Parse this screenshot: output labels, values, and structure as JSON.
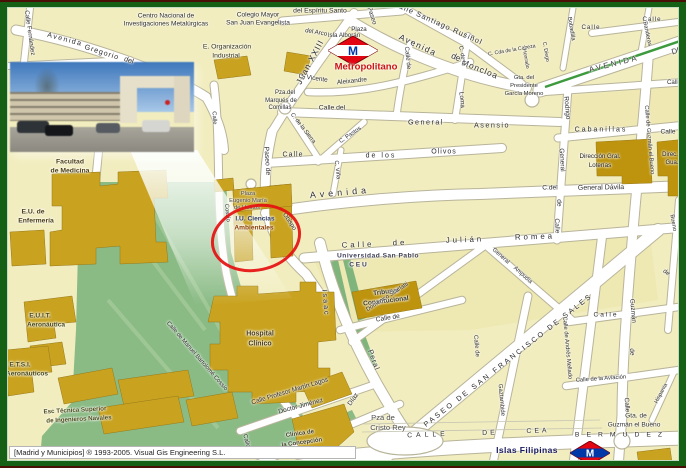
{
  "frame": {
    "copyright": "[Madrid y Municipios] ® 1993-2005. Visual Gis Engineering S.L.",
    "border_color": "#156015",
    "edge_line_color": "#4a1006"
  },
  "metro": {
    "m": "M",
    "top_label": "Metropolitano",
    "bottom_label": "Islas Filipinas",
    "diamond_color": "#e30613",
    "band_top_color": "#ffffff",
    "m_top_color": "#0038a8",
    "band_bottom_color": "#0038a8",
    "m_bottom_color": "#ffffff"
  },
  "colors": {
    "map_bg": "#f2edbe",
    "road": "#ffffff",
    "road_casing": "#b8b49a",
    "park": "#8abb85",
    "building": "#c9a320",
    "building_dark": "#be940e",
    "highlight_circle": "#e51010",
    "avenue_median_green": "#3d9a3d"
  },
  "map": {
    "labels": [
      {
        "t": "Centro Nacional de",
        "x": 166,
        "y": 17,
        "s": 6.6
      },
      {
        "t": "Investigaciones Metalúrgicas",
        "x": 166,
        "y": 25,
        "s": 6.6
      },
      {
        "t": "Colegio Mayor",
        "x": 258,
        "y": 16,
        "s": 6.6
      },
      {
        "t": "San Juan Evangelista",
        "x": 258,
        "y": 24,
        "s": 6.6
      },
      {
        "t": "del Espíritu Santo",
        "x": 320,
        "y": 12,
        "s": 6.8
      },
      {
        "t": "Avenida",
        "x": 65,
        "y": 39,
        "r": 15,
        "s": 7.2,
        "ls": 1.5
      },
      {
        "t": "Gregorio",
        "x": 102,
        "y": 52,
        "r": 18,
        "s": 7.2,
        "ls": 1
      },
      {
        "t": "del",
        "x": 129,
        "y": 60,
        "r": 20,
        "s": 7.2
      },
      {
        "t": "Calle Fernández",
        "x": 29,
        "y": 33,
        "r": 82,
        "s": 6.2
      },
      {
        "t": "E. Organización",
        "x": 227,
        "y": 48,
        "s": 6.8,
        "c": "#33331c"
      },
      {
        "t": "Industrial",
        "x": 226,
        "y": 57,
        "s": 6.8,
        "c": "#33331c"
      },
      {
        "t": "Paseo",
        "x": 371,
        "y": 16,
        "r": 72,
        "s": 6.4
      },
      {
        "t": "Plaza",
        "x": 359,
        "y": 30,
        "s": 6.2
      },
      {
        "t": "Isla Alborán",
        "x": 344,
        "y": 36,
        "s": 6.2
      },
      {
        "t": "del Arco",
        "x": 316,
        "y": 33,
        "r": 10,
        "s": 6.2
      },
      {
        "t": "Juan XXIII",
        "x": 310,
        "y": 62,
        "r": -62,
        "s": 8.5,
        "ls": 1
      },
      {
        "t": "C. Vicente",
        "x": 313,
        "y": 79,
        "r": 8,
        "s": 6.4
      },
      {
        "t": "Aleixandre",
        "x": 352,
        "y": 82,
        "r": -6,
        "s": 6.4
      },
      {
        "t": "Calle Santiago Rusiñol",
        "x": 438,
        "y": 23,
        "r": 24,
        "s": 7.4,
        "ls": 1
      },
      {
        "t": "Avenida",
        "x": 418,
        "y": 45,
        "r": 25,
        "s": 8.4,
        "ls": 1.5
      },
      {
        "t": "de",
        "x": 456,
        "y": 57,
        "r": 25,
        "s": 8.4
      },
      {
        "t": "Moncloa",
        "x": 480,
        "y": 69,
        "r": 22,
        "s": 8.4,
        "ls": 1
      },
      {
        "t": "C. Cda de la Cabeza",
        "x": 512,
        "y": 51,
        "r": -10,
        "s": 5.2
      },
      {
        "t": "Honrado",
        "x": 525,
        "y": 59,
        "r": 80,
        "s": 5.2
      },
      {
        "t": "C. Diego",
        "x": 545,
        "y": 52,
        "r": 80,
        "s": 5.2
      },
      {
        "t": "Gta. del",
        "x": 524,
        "y": 79,
        "s": 5.8
      },
      {
        "t": "Presidente",
        "x": 524,
        "y": 87,
        "s": 5.8
      },
      {
        "t": "García Moreno",
        "x": 524,
        "y": 95,
        "s": 5.8
      },
      {
        "t": "AVENIDA",
        "x": 614,
        "y": 64,
        "r": -14,
        "s": 7.8,
        "ls": 2.5,
        "c": "#3a3a3a"
      },
      {
        "t": "DE",
        "x": 677,
        "y": 51,
        "r": -16,
        "s": 7.8,
        "c": "#3a3a3a"
      },
      {
        "t": "Calle",
        "x": 591,
        "y": 28,
        "s": 6.2,
        "ls": 1
      },
      {
        "t": "Calle",
        "x": 652,
        "y": 20,
        "s": 6.2,
        "ls": 1
      },
      {
        "t": "Bobadilla",
        "x": 570,
        "y": 29,
        "r": 80,
        "s": 5.8
      },
      {
        "t": "Banderas",
        "x": 646,
        "y": 34,
        "r": 78,
        "s": 5.8
      },
      {
        "t": "Calle de",
        "x": 407,
        "y": 58,
        "r": 84,
        "s": 6.2
      },
      {
        "t": "C. de la",
        "x": 461,
        "y": 56,
        "r": 80,
        "s": 5.8
      },
      {
        "t": "Loma",
        "x": 461,
        "y": 100,
        "r": 84,
        "s": 6.4
      },
      {
        "t": "Pza.del",
        "x": 285,
        "y": 93,
        "s": 6
      },
      {
        "t": "Marqués de",
        "x": 281,
        "y": 101,
        "s": 6
      },
      {
        "t": "Comillas",
        "x": 280,
        "y": 108,
        "s": 6
      },
      {
        "t": "Calle del",
        "x": 332,
        "y": 109,
        "s": 6.8
      },
      {
        "t": "General",
        "x": 426,
        "y": 122,
        "s": 7.2,
        "ls": 1.5
      },
      {
        "t": "Asensio",
        "x": 492,
        "y": 125,
        "s": 7.2,
        "ls": 1.5
      },
      {
        "t": "Rodrigo",
        "x": 566,
        "y": 108,
        "r": 85,
        "s": 6.6
      },
      {
        "t": "General",
        "x": 561,
        "y": 160,
        "r": 87,
        "s": 6.6
      },
      {
        "t": "de",
        "x": 558,
        "y": 203,
        "r": 87,
        "s": 6.6
      },
      {
        "t": "Calle",
        "x": 556,
        "y": 226,
        "r": 87,
        "s": 6.6
      },
      {
        "t": "Cabanillas",
        "x": 601,
        "y": 130,
        "s": 7,
        "ls": 2
      },
      {
        "t": "Calle",
        "x": 668,
        "y": 133,
        "s": 6.6
      },
      {
        "t": "Calle",
        "x": 674,
        "y": 83,
        "s": 6.2
      },
      {
        "t": "Dirección Gral.",
        "x": 600,
        "y": 157,
        "s": 6.2,
        "c": "#1f1f1f"
      },
      {
        "t": "Loterías",
        "x": 600,
        "y": 166,
        "s": 6.2,
        "c": "#1f1f1f"
      },
      {
        "t": "Direc.",
        "x": 670,
        "y": 155,
        "s": 6,
        "c": "#1f1f1f"
      },
      {
        "t": "Gua.",
        "x": 672,
        "y": 163,
        "s": 6,
        "c": "#1f1f1f"
      },
      {
        "t": "Calle",
        "x": 293,
        "y": 155,
        "s": 7,
        "ls": 1
      },
      {
        "t": "de los",
        "x": 381,
        "y": 156,
        "s": 7,
        "ls": 2
      },
      {
        "t": "Olivos",
        "x": 444,
        "y": 152,
        "s": 7,
        "ls": 1
      },
      {
        "t": "C. de la Sierra",
        "x": 302,
        "y": 129,
        "r": 52,
        "s": 5.8
      },
      {
        "t": "C. Pastos",
        "x": 351,
        "y": 136,
        "r": -35,
        "s": 5.8
      },
      {
        "t": "C. Viña",
        "x": 336,
        "y": 170,
        "r": 84,
        "s": 5.8
      },
      {
        "t": "Paseo de",
        "x": 266,
        "y": 161,
        "r": 86,
        "s": 6.8
      },
      {
        "t": "Avenida",
        "x": 340,
        "y": 193,
        "r": -5,
        "s": 9,
        "ls": 4
      },
      {
        "t": "C.del",
        "x": 550,
        "y": 189,
        "s": 6.6
      },
      {
        "t": "General Dávila",
        "x": 601,
        "y": 188,
        "r": -1,
        "s": 7
      },
      {
        "t": "Obispo",
        "x": 289,
        "y": 222,
        "r": 56,
        "s": 6.2
      },
      {
        "t": "Plaza",
        "x": 248,
        "y": 195,
        "s": 5.8,
        "c": "#4a4a4a"
      },
      {
        "t": "Eugenio María",
        "x": 248,
        "y": 202,
        "s": 5.8,
        "c": "#4a4a4a"
      },
      {
        "t": "de Hostos",
        "x": 247,
        "y": 209,
        "s": 5.8,
        "c": "#4a4a4a"
      },
      {
        "t": "I.U. Ciencias",
        "x": 255,
        "y": 220,
        "s": 6.6,
        "w": 700,
        "c": "#2a3a62"
      },
      {
        "t": "Ambientales",
        "x": 254,
        "y": 229,
        "s": 6.6,
        "w": 700,
        "c": "#8a3d00"
      },
      {
        "t": "Universidad San Pablo",
        "x": 378,
        "y": 257,
        "s": 6.6,
        "w": 700,
        "c": "#3e3e58",
        "ls": 0.5
      },
      {
        "t": "C E U",
        "x": 358,
        "y": 266,
        "s": 6.6,
        "w": 700,
        "c": "#3e3e58"
      },
      {
        "t": "Calle",
        "x": 358,
        "y": 245,
        "r": -2,
        "s": 7.8,
        "ls": 3
      },
      {
        "t": "de",
        "x": 400,
        "y": 243,
        "r": -2,
        "s": 7.8,
        "ls": 3
      },
      {
        "t": "Julián",
        "x": 465,
        "y": 240,
        "r": -2,
        "s": 7.8,
        "ls": 3
      },
      {
        "t": "Romea",
        "x": 535,
        "y": 237,
        "r": -2,
        "s": 7.8,
        "ls": 3
      },
      {
        "t": "Tribunal",
        "x": 386,
        "y": 293,
        "r": -7,
        "s": 6.6,
        "w": 700,
        "c": "#3a3a26"
      },
      {
        "t": "Constitucional",
        "x": 386,
        "y": 302,
        "r": -7,
        "s": 6.6,
        "w": 700,
        "c": "#3a3a26"
      },
      {
        "t": "Calle de",
        "x": 388,
        "y": 319,
        "r": -9,
        "s": 6.6
      },
      {
        "t": "Domenico Scarlatti",
        "x": 388,
        "y": 298,
        "r": -33,
        "s": 5.8
      },
      {
        "t": "General",
        "x": 500,
        "y": 257,
        "r": 42,
        "s": 5.8
      },
      {
        "t": "Ampudia",
        "x": 522,
        "y": 276,
        "r": 42,
        "s": 5.8
      },
      {
        "t": "PASEO DE SAN FRANCISCO DE SALES",
        "x": 508,
        "y": 360,
        "r": -38,
        "s": 7.2,
        "ls": 2.5
      },
      {
        "t": "Isaac",
        "x": 326,
        "y": 303,
        "r": 85,
        "s": 7.2,
        "ls": 2
      },
      {
        "t": "Peral",
        "x": 374,
        "y": 360,
        "r": 70,
        "s": 7.2,
        "ls": 1
      },
      {
        "t": "Calle",
        "x": 213,
        "y": 118,
        "r": 86,
        "s": 5.8
      },
      {
        "t": "Cossío",
        "x": 226,
        "y": 213,
        "r": 84,
        "s": 5.8
      },
      {
        "t": "Calle de Manuel Bartolomé Cossío",
        "x": 196,
        "y": 357,
        "r": 49,
        "s": 5.8
      },
      {
        "t": "Hospital",
        "x": 260,
        "y": 334,
        "s": 7,
        "w": 700,
        "c": "#4a3c14"
      },
      {
        "t": "Clínico",
        "x": 260,
        "y": 344,
        "s": 7,
        "w": 700,
        "c": "#4a3c14"
      },
      {
        "t": "Calle Profesor Martín Lagos",
        "x": 290,
        "y": 392,
        "r": -17,
        "s": 6.4
      },
      {
        "t": "Doctor Jiménez",
        "x": 301,
        "y": 407,
        "r": -15,
        "s": 6.6
      },
      {
        "t": "Díaz",
        "x": 354,
        "y": 400,
        "r": -55,
        "s": 6.6
      },
      {
        "t": "Calle",
        "x": 246,
        "y": 441,
        "r": 75,
        "s": 6
      },
      {
        "t": "Clínica de",
        "x": 300,
        "y": 434,
        "r": -8,
        "s": 6,
        "w": 700,
        "c": "#3f3f23"
      },
      {
        "t": "la Concepción",
        "x": 302,
        "y": 443,
        "r": -8,
        "s": 6,
        "w": 700,
        "c": "#3f3f23"
      },
      {
        "t": "Pza de",
        "x": 383,
        "y": 418,
        "s": 7.6,
        "c": "#4f4f4f"
      },
      {
        "t": "Cristo Rey",
        "x": 388,
        "y": 428,
        "s": 7.6,
        "c": "#4f4f4f"
      },
      {
        "t": "CALLE",
        "x": 428,
        "y": 436,
        "r": -2,
        "s": 6.8,
        "ls": 4
      },
      {
        "t": "DE",
        "x": 490,
        "y": 434,
        "r": -2,
        "s": 6.8,
        "ls": 3
      },
      {
        "t": "CEA",
        "x": 538,
        "y": 432,
        "r": -2,
        "s": 6.8,
        "ls": 3
      },
      {
        "t": "BERMUDEZ",
        "x": 622,
        "y": 436,
        "s": 6.8,
        "ls": 7
      },
      {
        "t": "Gta. de",
        "x": 636,
        "y": 417,
        "s": 6.6,
        "c": "#333333"
      },
      {
        "t": "Guzmán el Bueno",
        "x": 634,
        "y": 426,
        "s": 6.6,
        "c": "#333333"
      },
      {
        "t": "Calle de Andrés Mellado",
        "x": 566,
        "y": 348,
        "r": 85,
        "s": 5.8
      },
      {
        "t": "Guzmán",
        "x": 632,
        "y": 311,
        "r": 85,
        "s": 6.4
      },
      {
        "t": "de",
        "x": 631,
        "y": 352,
        "r": 85,
        "s": 6.4
      },
      {
        "t": "Calle",
        "x": 626,
        "y": 405,
        "r": 85,
        "s": 6.4
      },
      {
        "t": "Calle de Guzmán el Bueno",
        "x": 648,
        "y": 140,
        "r": 85,
        "s": 5.8
      },
      {
        "t": "Bueno",
        "x": 672,
        "y": 223,
        "r": 80,
        "s": 5.8
      },
      {
        "t": "Calle de la Aviación",
        "x": 601,
        "y": 380,
        "r": -4,
        "s": 5.8
      },
      {
        "t": "Hispania",
        "x": 662,
        "y": 394,
        "r": -62,
        "s": 5.6
      },
      {
        "t": "Gaztambide",
        "x": 501,
        "y": 400,
        "r": 85,
        "s": 6
      },
      {
        "t": "Calle de",
        "x": 476,
        "y": 346,
        "r": 85,
        "s": 6
      },
      {
        "t": "Calle",
        "x": 606,
        "y": 316,
        "s": 6.6,
        "ls": 2
      },
      {
        "t": "de",
        "x": 666,
        "y": 273,
        "r": 35,
        "s": 6.2
      },
      {
        "t": "Facultad",
        "x": 70,
        "y": 163,
        "s": 6.8,
        "w": 700,
        "c": "#4a3c14"
      },
      {
        "t": "de Medicina",
        "x": 70,
        "y": 172,
        "s": 6.8,
        "w": 700,
        "c": "#4a3c14"
      },
      {
        "t": "E.U. de",
        "x": 33,
        "y": 213,
        "s": 6.8,
        "w": 700,
        "c": "#4a3c14"
      },
      {
        "t": "Enfermería",
        "x": 36,
        "y": 222,
        "s": 6.8,
        "w": 700,
        "c": "#4a3c14"
      },
      {
        "t": "E.U.I.T.",
        "x": 40,
        "y": 317,
        "s": 6.6,
        "w": 700,
        "c": "#474716"
      },
      {
        "t": "Aeronáutica",
        "x": 46,
        "y": 326,
        "s": 6.6,
        "w": 700,
        "c": "#474716"
      },
      {
        "t": "E.T.S.I.",
        "x": 20,
        "y": 366,
        "s": 6.6,
        "w": 700,
        "c": "#474716"
      },
      {
        "t": "Aeronáuticos",
        "x": 27,
        "y": 375,
        "s": 6.6,
        "w": 700,
        "c": "#474716"
      },
      {
        "t": "Esc Técnica Superior",
        "x": 75,
        "y": 411,
        "r": -3,
        "s": 6.2,
        "w": 700,
        "c": "#4a4a18"
      },
      {
        "t": "de Ingenieros Navales",
        "x": 79,
        "y": 420,
        "r": -3,
        "s": 6.2,
        "w": 700,
        "c": "#4a4a18"
      }
    ]
  }
}
